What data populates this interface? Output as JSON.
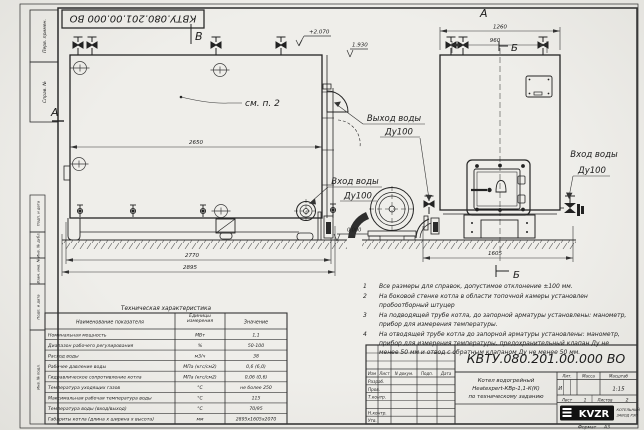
{
  "stamp_top": "КВТУ.080.201.00.000  ВО",
  "margin": {
    "labels": [
      "Перв. примен.",
      "Справ. №",
      "Подп. и дата",
      "Инв. № дубл.",
      "Взам. инв. №",
      "Подп. и дата",
      "Инв. № подл."
    ]
  },
  "drawing": {
    "markers": {
      "v": "В",
      "a": "А",
      "b": "Б"
    },
    "callout": "см. п. 2",
    "elev": {
      "top": "+2.070",
      "mid": "1.930",
      "zero": "0.000"
    },
    "dims": {
      "d2650": "2650",
      "d2770": "2770",
      "d2895": "2895",
      "d1260": "1260",
      "d960": "960",
      "d1605": "1605"
    },
    "labels": {
      "outlet": "Выход воды",
      "inlet": "Вход воды",
      "dn": "Ду100"
    }
  },
  "notes": [
    {
      "num": "1",
      "text": "Все размеры для справок, допустимое отклонение ±100 мм."
    },
    {
      "num": "2",
      "text": "На боковой стенке котла в области топочной камеры установлен пробоотборный штуцер"
    },
    {
      "num": "3",
      "text": "На подводящей трубе котла, до запорной арматуры установлены: манометр, прибор для измерения температуры."
    },
    {
      "num": "4",
      "text": "На отводящей трубе котла до запорной арматуры установлены: манометр, прибор для измерения температуры, предохранительный клапан Ду не менее 50 мм и отвод с обратным клапаном Ду не менее 50 мм."
    }
  ],
  "spec_table": {
    "title": "Техническая характеристика",
    "headers": [
      "Наименование показателя",
      "Единицы измерения",
      "Значение"
    ],
    "rows": [
      [
        "Номинальная мощность",
        "МВт",
        "1,1"
      ],
      [
        "Диапазон рабочего регулирования",
        "%",
        "50-100"
      ],
      [
        "Расход воды",
        "м3/ч",
        "38"
      ],
      [
        "Рабочее давление воды",
        "МПа (кгс/см2)",
        "0,6 (6,0)"
      ],
      [
        "Гидравлическое сопротивление котла",
        "МПа (кгс/см2)",
        "0,06 (0,6)"
      ],
      [
        "Температура уходящих газов",
        "°С",
        "не более 250"
      ],
      [
        "Максимальная рабочая температура воды",
        "°С",
        "115"
      ],
      [
        "Температура воды (вход/выход)",
        "°С",
        "70/95"
      ],
      [
        "Габариты котла (длина х ширина х высота)",
        "мм",
        "2895х1605х2070"
      ]
    ]
  },
  "title_block": {
    "doc_number": "КВТУ.080.201.00.000  ВО",
    "name_lines": [
      "Котел водогрейный",
      "Heatexpert-КВр-1,1-К(К)",
      "по техническому заданию"
    ],
    "header_cells": [
      "Изм",
      "Лист",
      "N докум.",
      "Подп.",
      "Дата"
    ],
    "roles": [
      "Разраб.",
      "Пров.",
      "Т.контр.",
      "",
      "Н.контр.",
      "Утв."
    ],
    "lit_label": "Лит.",
    "mass_label": "Масса",
    "scale_label": "Масштаб",
    "lit_value": "И",
    "scale_value": "1:15",
    "sheet_label": "Лист",
    "sheet_value": "1",
    "sheets_label": "Листов",
    "sheets_value": "2",
    "logo_text": "KVZR",
    "org_line1": "КОТЕЛЬНЫЙ",
    "org_line2": "ЗАВОД РЭП",
    "format_label": "Формат",
    "format_value": "А3"
  }
}
